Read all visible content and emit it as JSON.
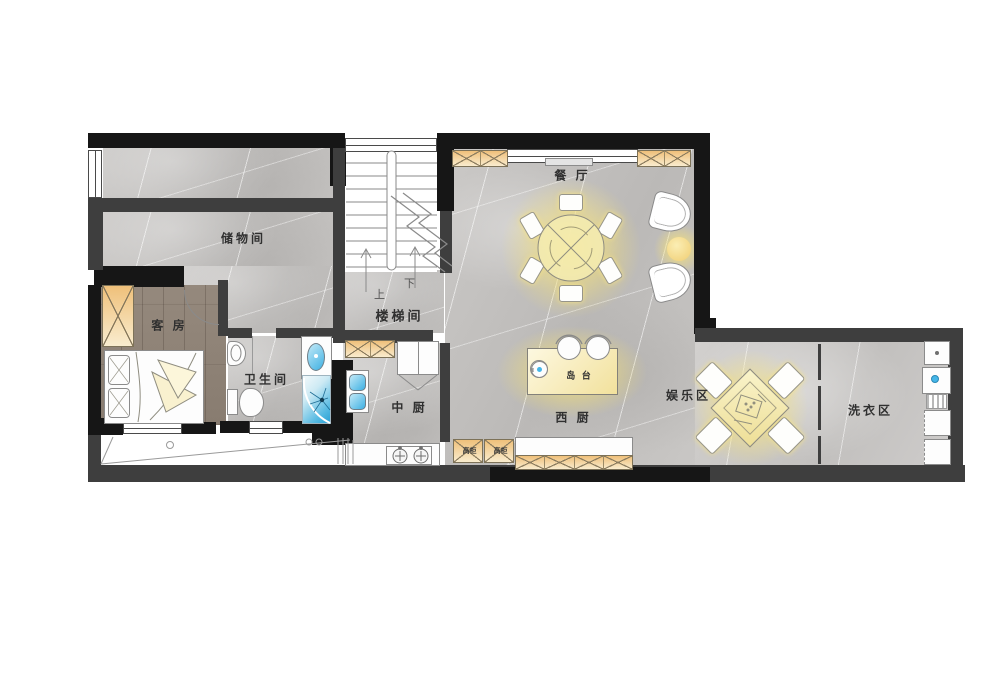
{
  "floorplan": {
    "rooms": {
      "storage": {
        "label": "储物间"
      },
      "guest_room": {
        "label": "客 房"
      },
      "bathroom": {
        "label": "卫生间"
      },
      "stairwell": {
        "label": "楼梯间",
        "up": "上",
        "down": "下"
      },
      "chinese_kitchen": {
        "label": "中 厨"
      },
      "western_kitchen": {
        "label": "西 厨"
      },
      "dining_room": {
        "label": "餐 厅"
      },
      "island_counter": {
        "label": "岛 台"
      },
      "entertainment": {
        "label": "娱乐区"
      },
      "laundry": {
        "label": "洗衣区"
      }
    },
    "fixtures": {
      "tall_cabinet_left": {
        "label": "高柜"
      },
      "tall_cabinet_right": {
        "label": "高柜"
      }
    },
    "colors": {
      "wall_dark": "#161616",
      "wall_gray": "#3e3e3e",
      "marble_floor": "#c6c4c2",
      "wood_floor": "#8f8378",
      "cabinet_orange": "#efc07a",
      "warm_glow": "#f7e47a",
      "water_blue": "#45b6e8"
    }
  }
}
